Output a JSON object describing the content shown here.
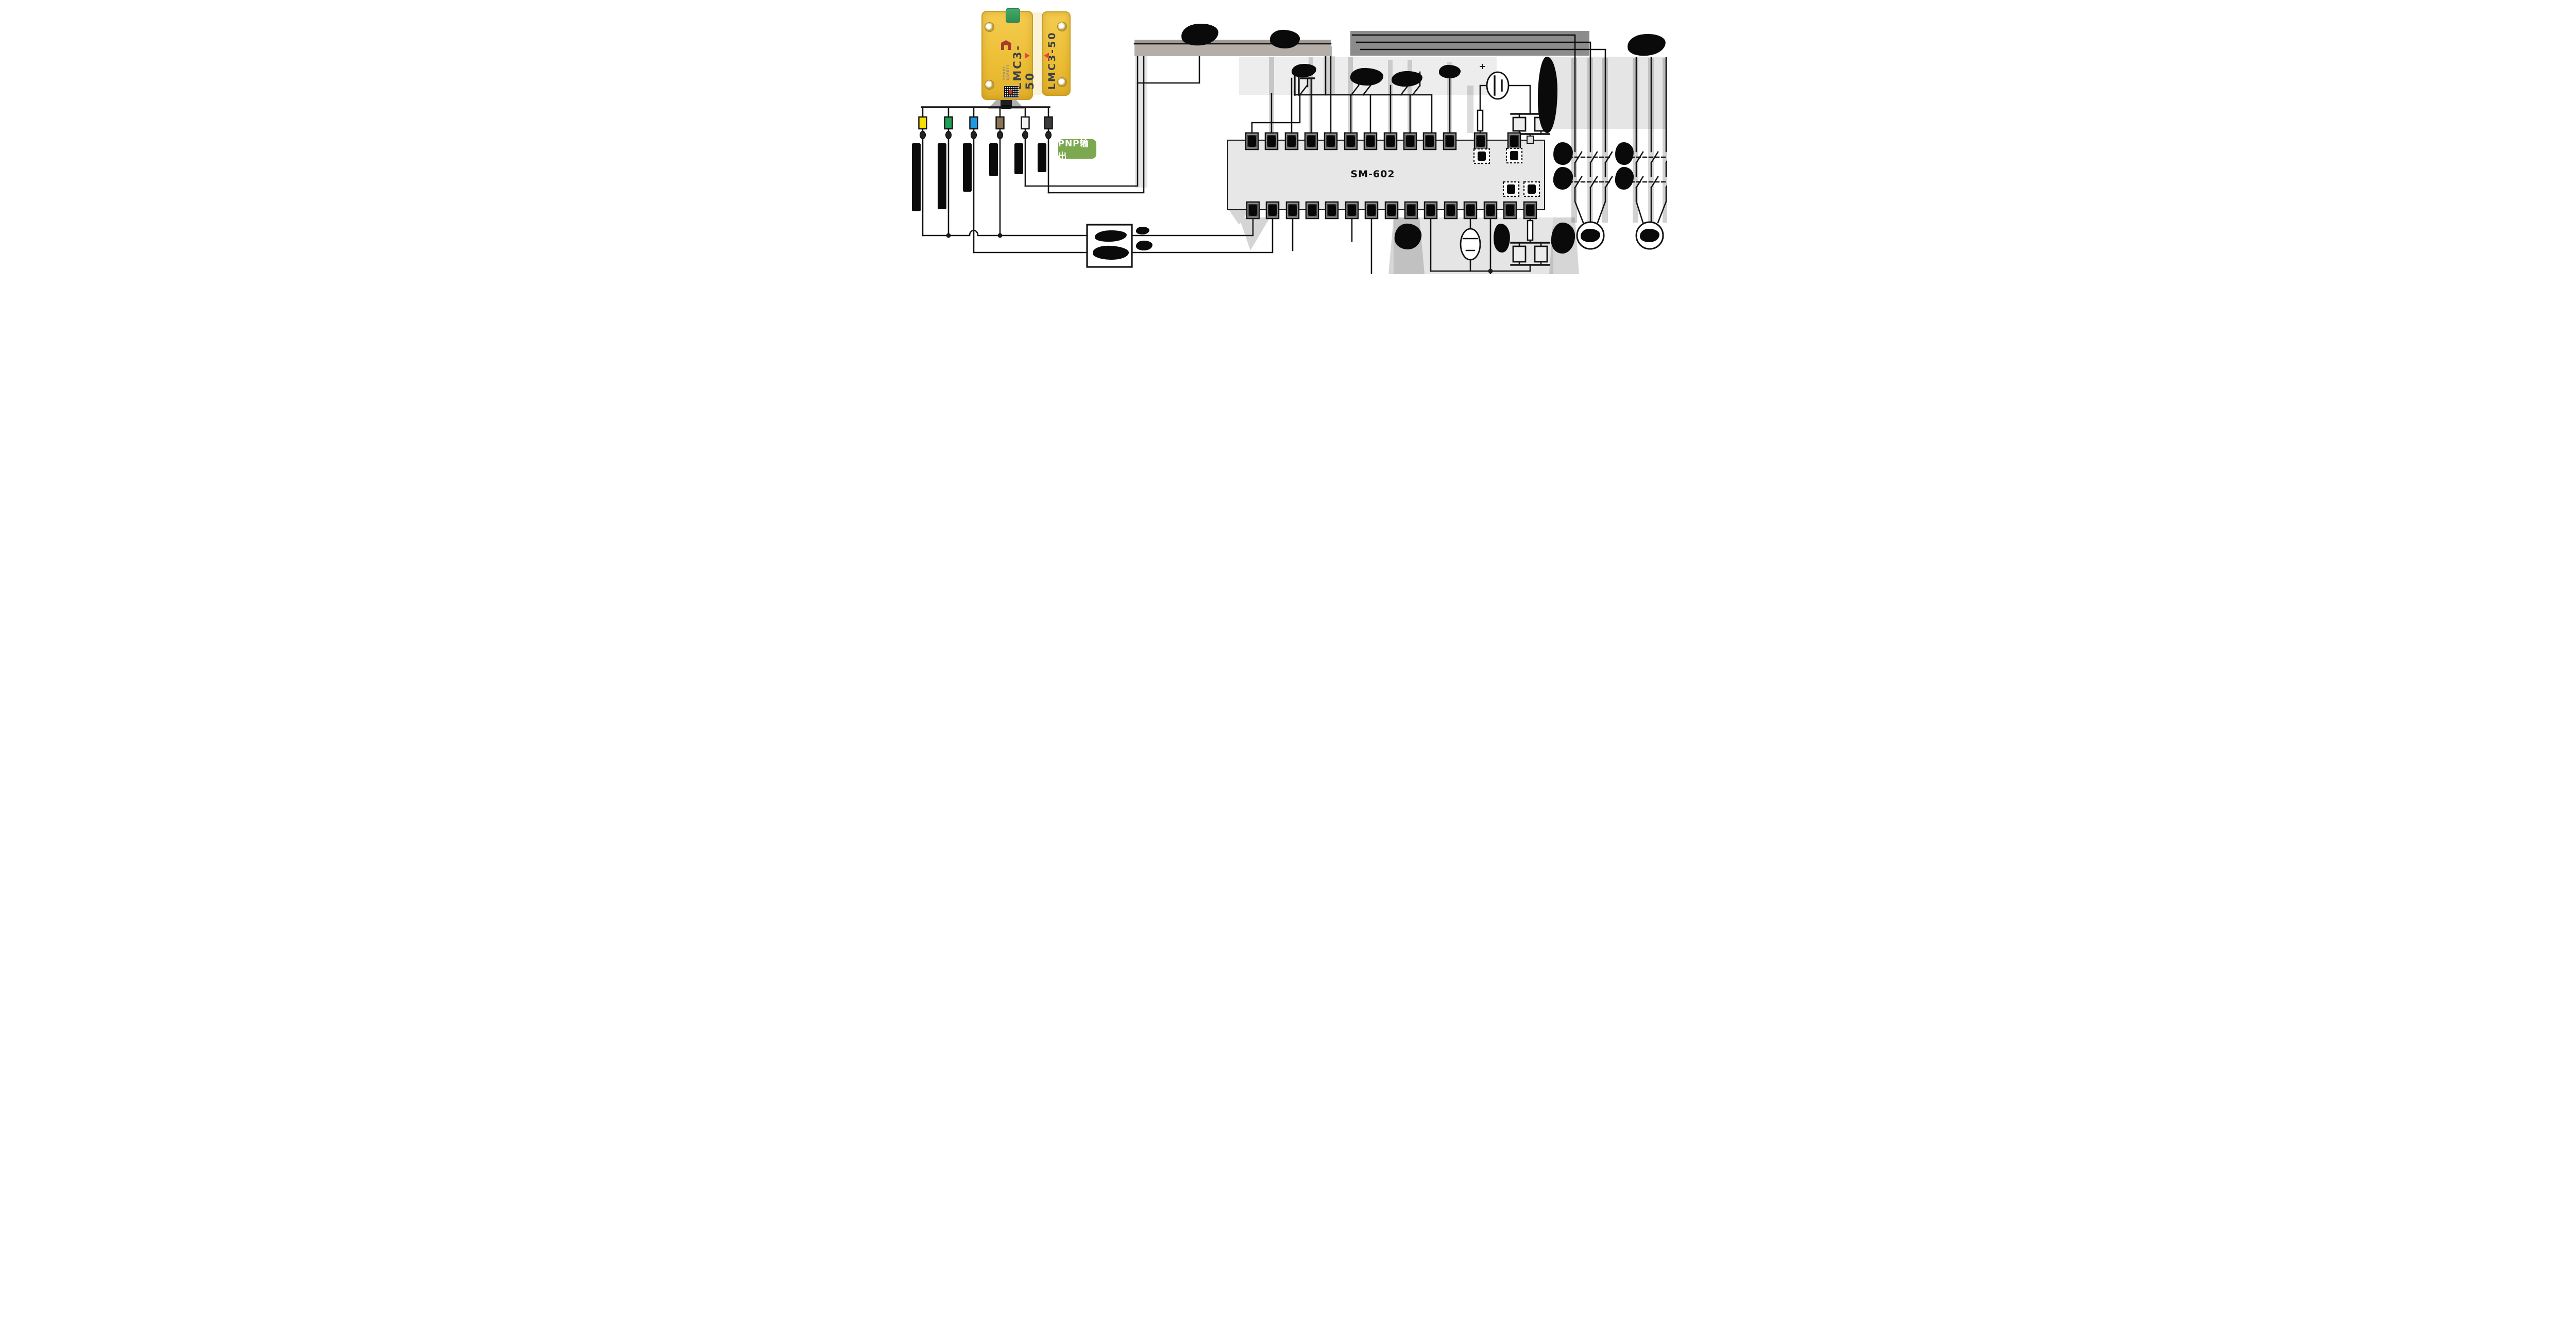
{
  "diagram_type": "safety-switch-wiring-diagram",
  "sensor": {
    "switch_model": "LMC3-50",
    "actuator_model": "LMC3-50",
    "brand": "SMART SAFETY"
  },
  "output_badge": {
    "label": "PNP输出",
    "bg_color": "#7CA94F",
    "text_color": "#FFFFFF"
  },
  "safety_relay": {
    "model": "SM-602",
    "body_color": "#E7E7E7",
    "top_terminal_count": 13,
    "bottom_terminal_count": 15
  },
  "power_supply": {
    "polarity_label": "+"
  },
  "wires": [
    {
      "name": "yellow",
      "hex": "#F7E000"
    },
    {
      "name": "green",
      "hex": "#209F57"
    },
    {
      "name": "blue",
      "hex": "#1E9BE0"
    },
    {
      "name": "brown",
      "hex": "#8A7355"
    },
    {
      "name": "white",
      "hex": "#F4F4F2"
    },
    {
      "name": "black",
      "hex": "#3B3B3B"
    }
  ]
}
